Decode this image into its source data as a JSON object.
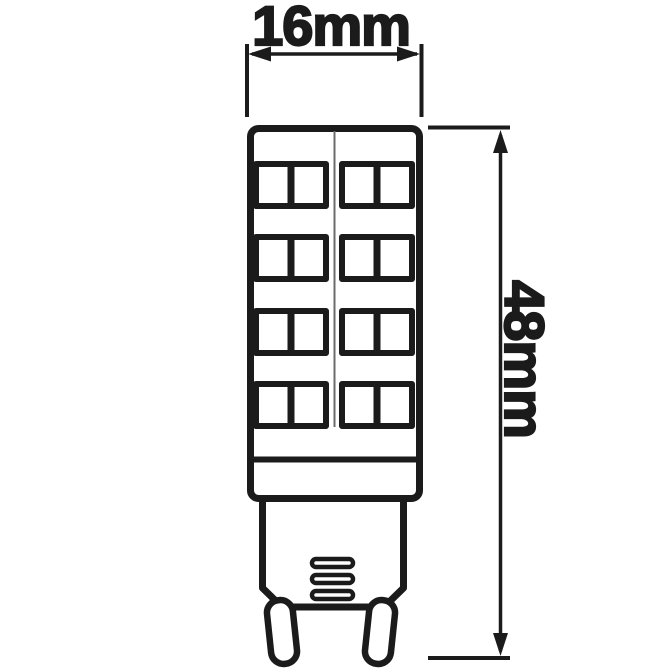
{
  "page": {
    "background_color": "#ffffff"
  },
  "dimensions": {
    "width": {
      "label": "16mm"
    },
    "height": {
      "label": "48mm"
    }
  },
  "drawing": {
    "line_color": "#1b1b1b",
    "fill_color": "#ffffff",
    "subject": "G9 LED capsule bulb outline drawing",
    "led_chips": {
      "rows": 4,
      "columns": 2,
      "count": 8
    },
    "vent_slots": 3,
    "pins": 2
  }
}
